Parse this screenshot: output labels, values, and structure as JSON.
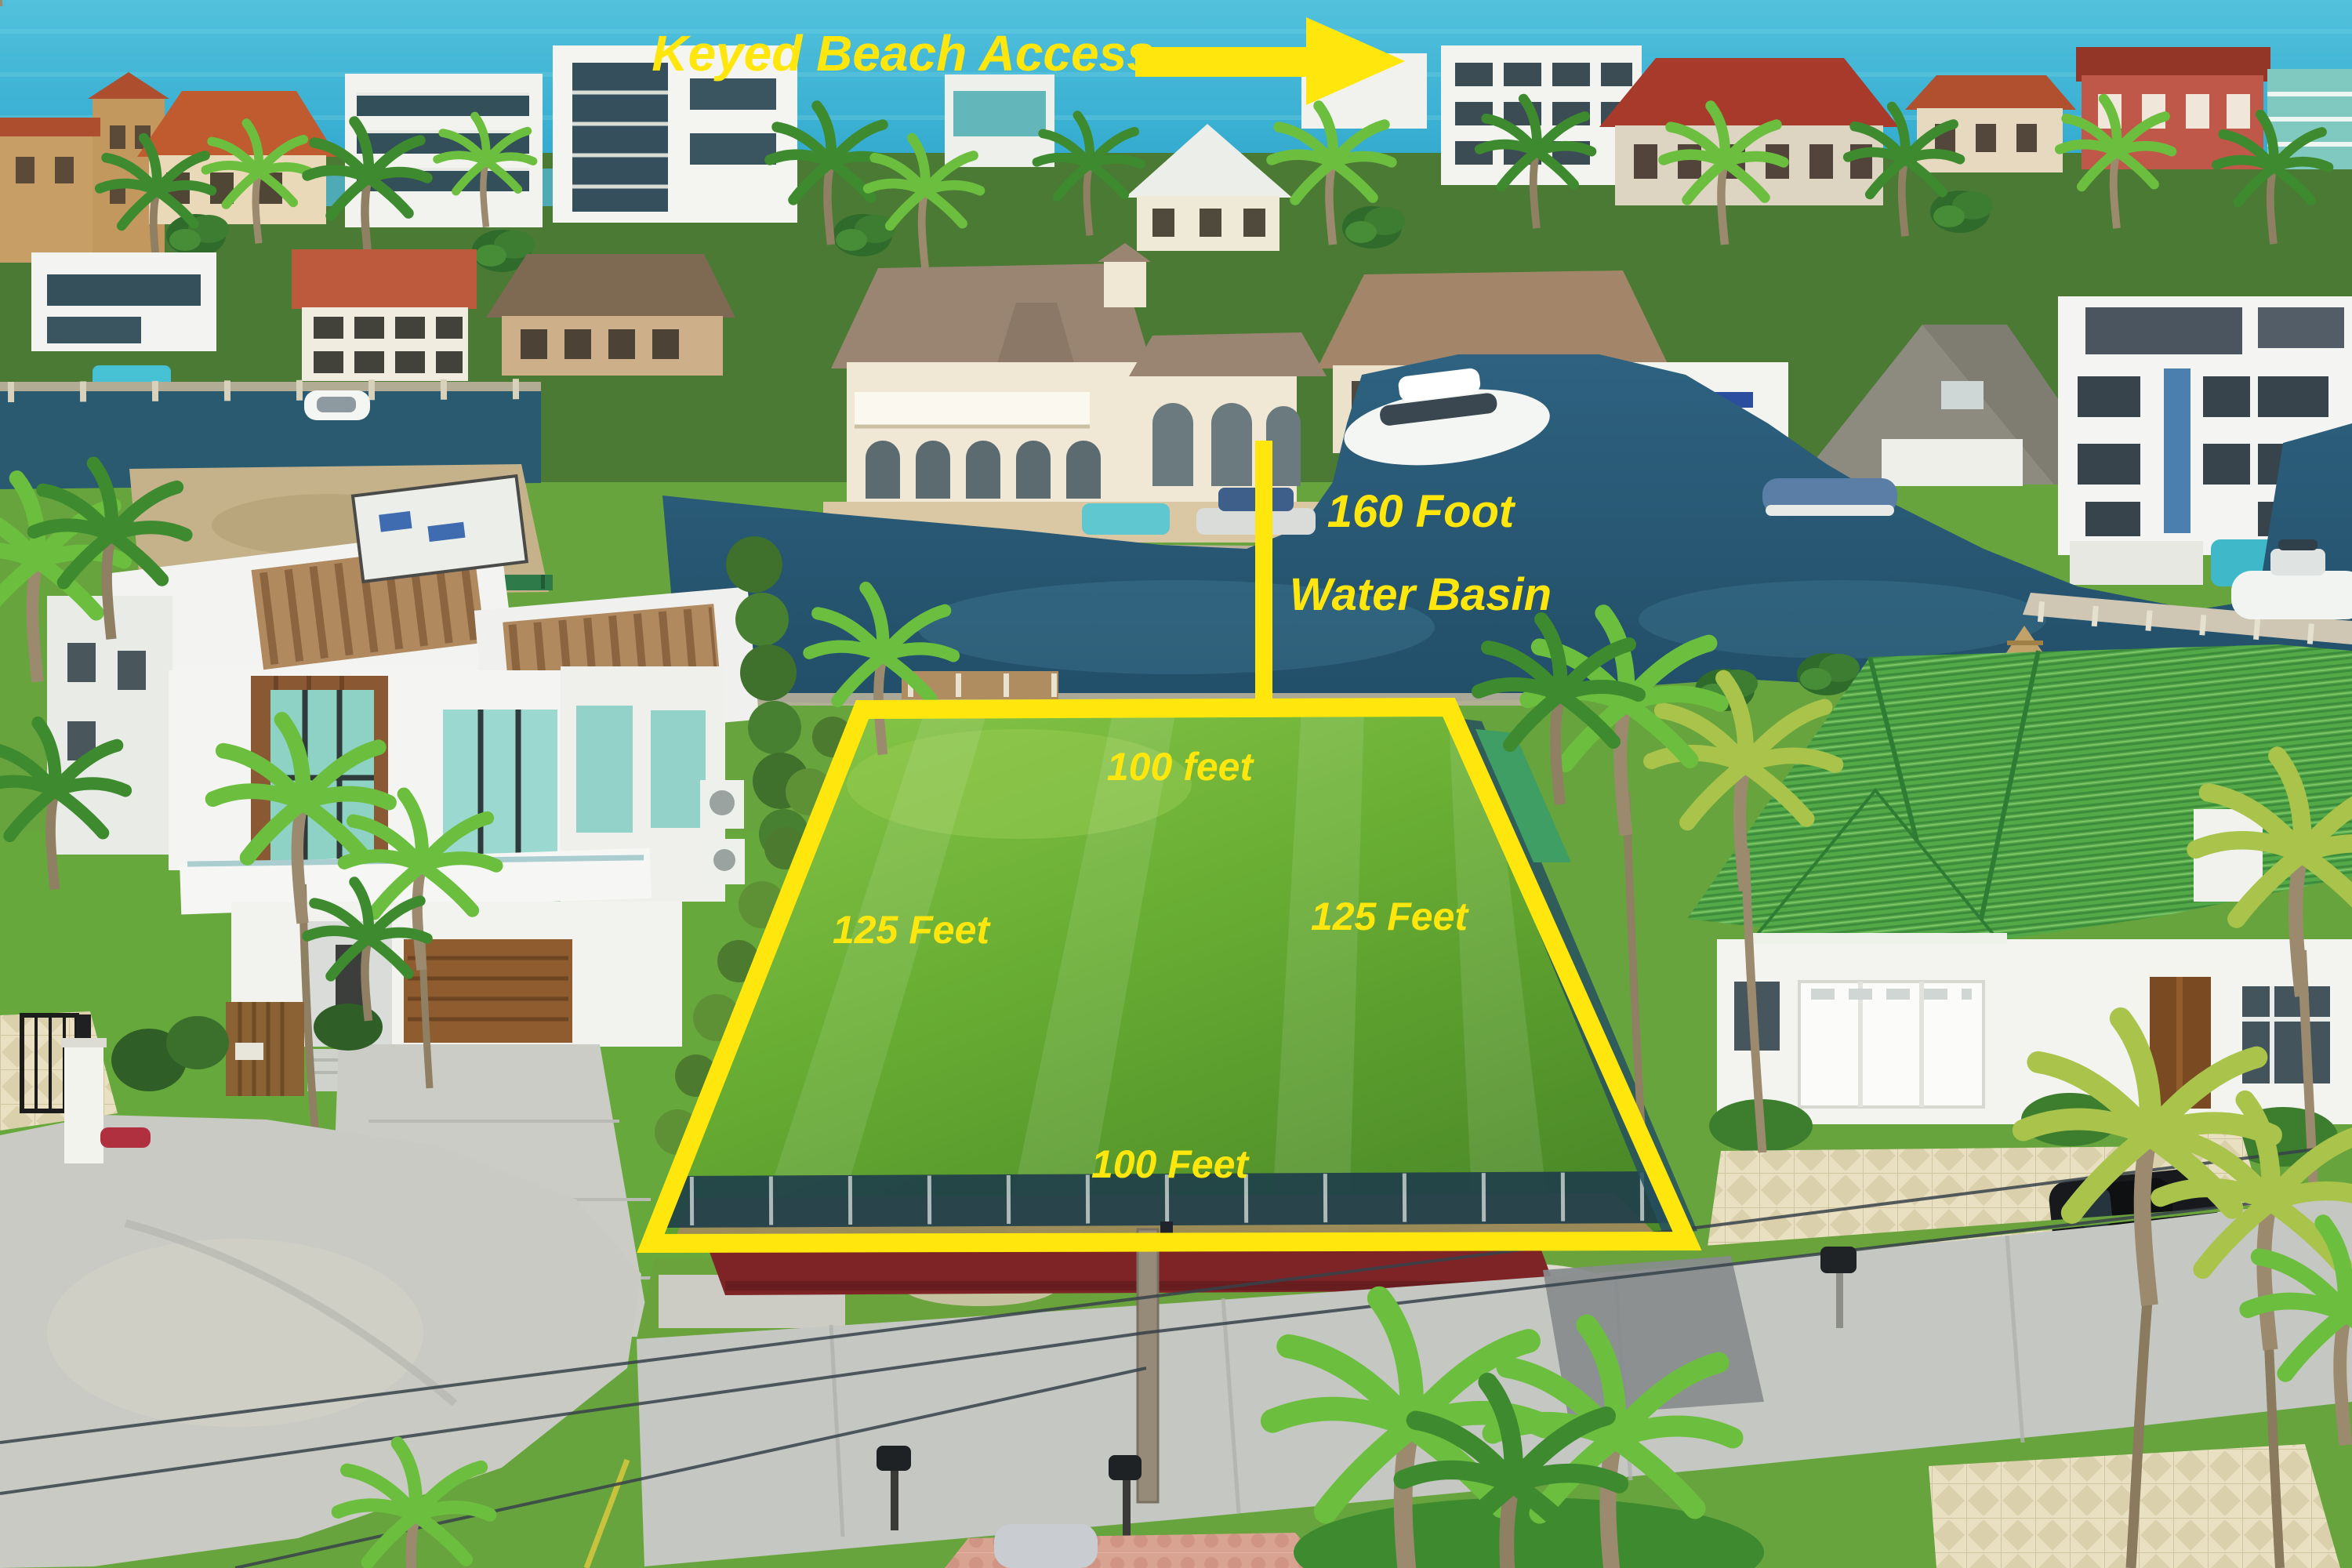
{
  "annotations": {
    "beach_access_label": "Keyed Beach Access",
    "basin_label_line1": "160 Foot",
    "basin_label_line2": "Water Basin",
    "lot_top_label": "100 feet",
    "lot_left_label": "125 Feet",
    "lot_right_label": "125 Feet",
    "lot_bottom_label": "100 Feet"
  },
  "icons": {
    "beach_access_arrow": "right-arrow"
  },
  "colors": {
    "annotation_yellow": "#ffe70d"
  }
}
